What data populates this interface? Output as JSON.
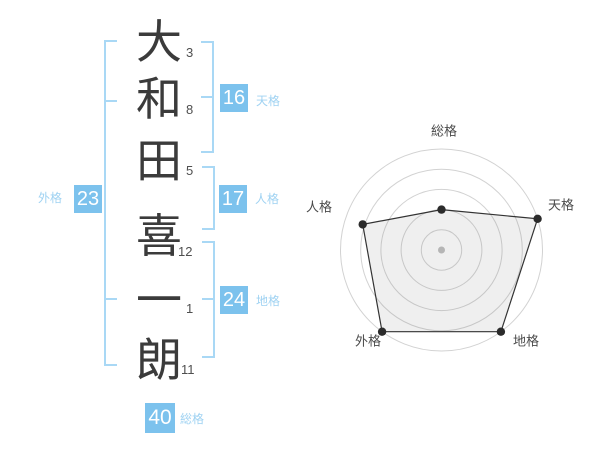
{
  "colors": {
    "badge_blue": "#7CC2ED",
    "bracket_blue": "#A9D8F5",
    "label_blue": "#9FD2F2",
    "kanji_dark": "#3B3B3B",
    "number_gray": "#4F4F4F",
    "radar_grid_gray": "#D2D2D2",
    "radar_line_dark": "#333333",
    "background": "#FFFFFF"
  },
  "name_analysis": {
    "characters": [
      {
        "char": "大",
        "strokes": "3"
      },
      {
        "char": "和",
        "strokes": "8"
      },
      {
        "char": "田",
        "strokes": "5"
      },
      {
        "char": "喜",
        "strokes": "12"
      },
      {
        "char": "一",
        "strokes": "1"
      },
      {
        "char": "朗",
        "strokes": "11"
      }
    ],
    "gokaku": {
      "tenkaku": {
        "label": "天格",
        "value": "16"
      },
      "jinkaku": {
        "label": "人格",
        "value": "17"
      },
      "chikaku": {
        "label": "地格",
        "value": "24"
      },
      "gaikaku": {
        "label": "外格",
        "value": "23"
      },
      "soukaku": {
        "label": "総格",
        "value": "40"
      }
    }
  },
  "chart_data": {
    "type": "radar",
    "title": "",
    "axes": [
      "総格",
      "天格",
      "地格",
      "外格",
      "人格"
    ],
    "values_normalized": [
      0.4,
      1.0,
      1.0,
      1.0,
      0.82
    ],
    "axis_scores": {
      "総格": 40,
      "天格": 16,
      "地格": 24,
      "外格": 23,
      "人格": 17
    },
    "rings": 5,
    "grid": "concentric-circles",
    "legend": "none"
  }
}
